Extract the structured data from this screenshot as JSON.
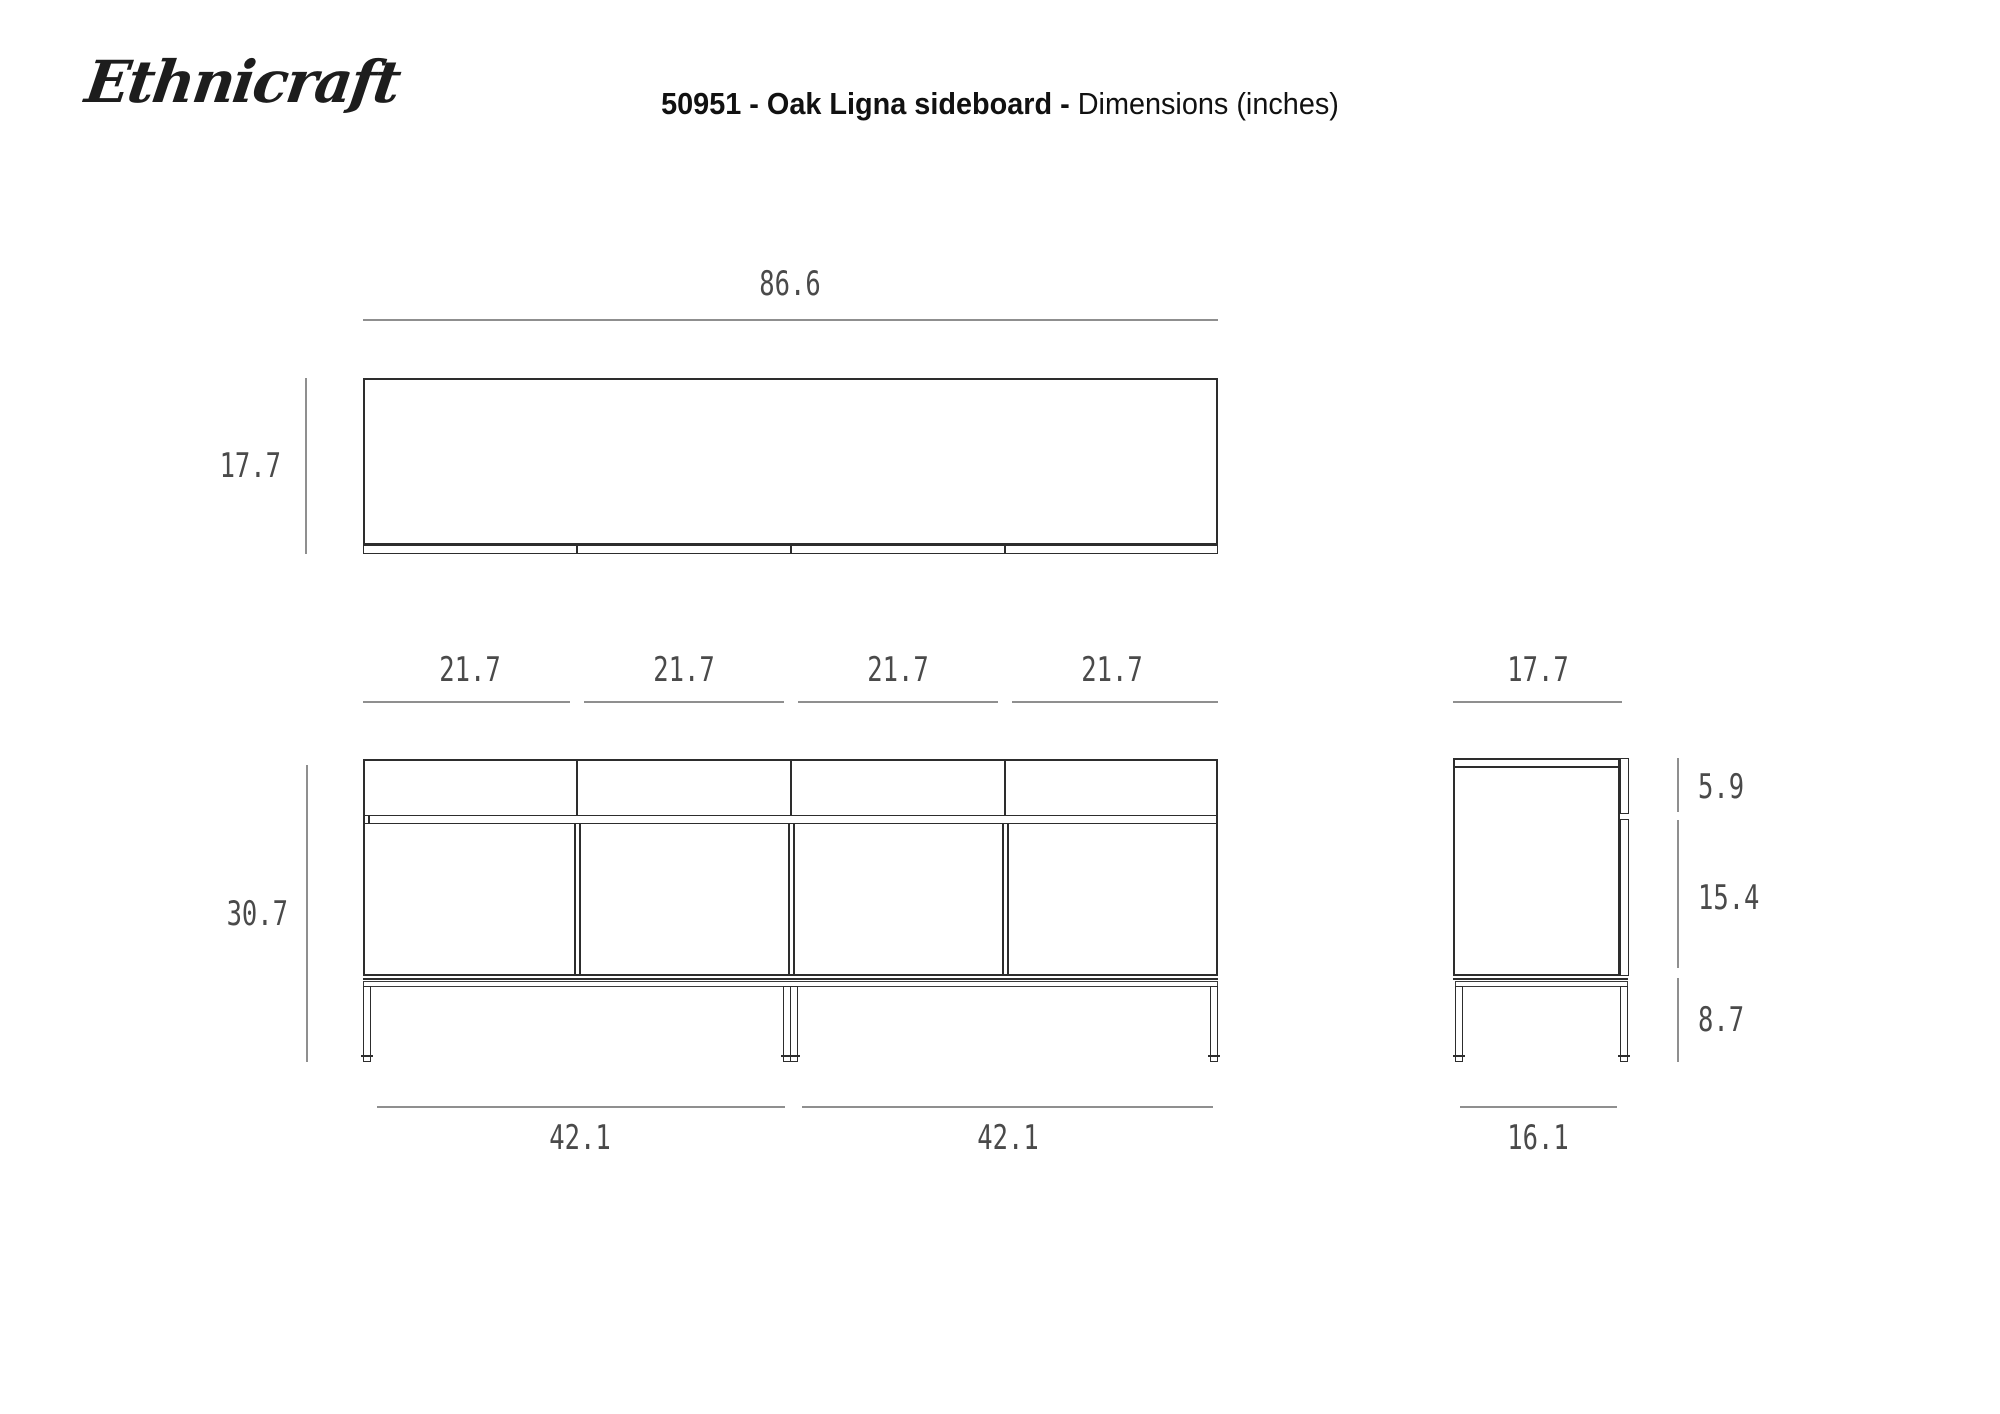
{
  "brand": {
    "logo": "Ethnicraft"
  },
  "title": {
    "bold": "50951 - Oak Ligna sideboard -",
    "regular": "Dimensions (inches)"
  },
  "dims": {
    "top_view": {
      "width": "86.6",
      "depth": "17.7"
    },
    "front_view": {
      "sections": [
        "21.7",
        "21.7",
        "21.7",
        "21.7"
      ],
      "height": "30.7",
      "bases": [
        "42.1",
        "42.1"
      ]
    },
    "side_view": {
      "depth": "17.7",
      "drawer": "5.9",
      "door": "15.4",
      "legs": "8.7",
      "base": "16.1"
    }
  },
  "colors": {
    "outline": "#2d2d2d",
    "dimension_line": "#8f8f8f",
    "dimension_text": "#4a4a4a",
    "title_text": "#111111",
    "background": "#ffffff"
  }
}
